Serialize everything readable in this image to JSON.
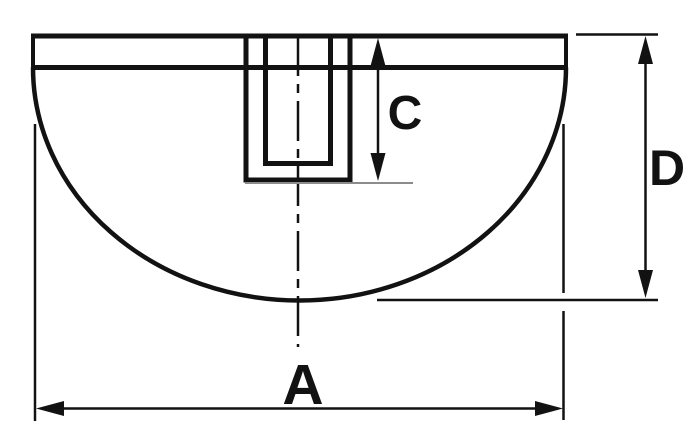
{
  "dimension_labels": {
    "width": "A",
    "hole_depth": "C",
    "height": "D"
  },
  "colors": {
    "ink": "#121212",
    "gray": "#8c8c8c",
    "bg": "#ffffff"
  }
}
